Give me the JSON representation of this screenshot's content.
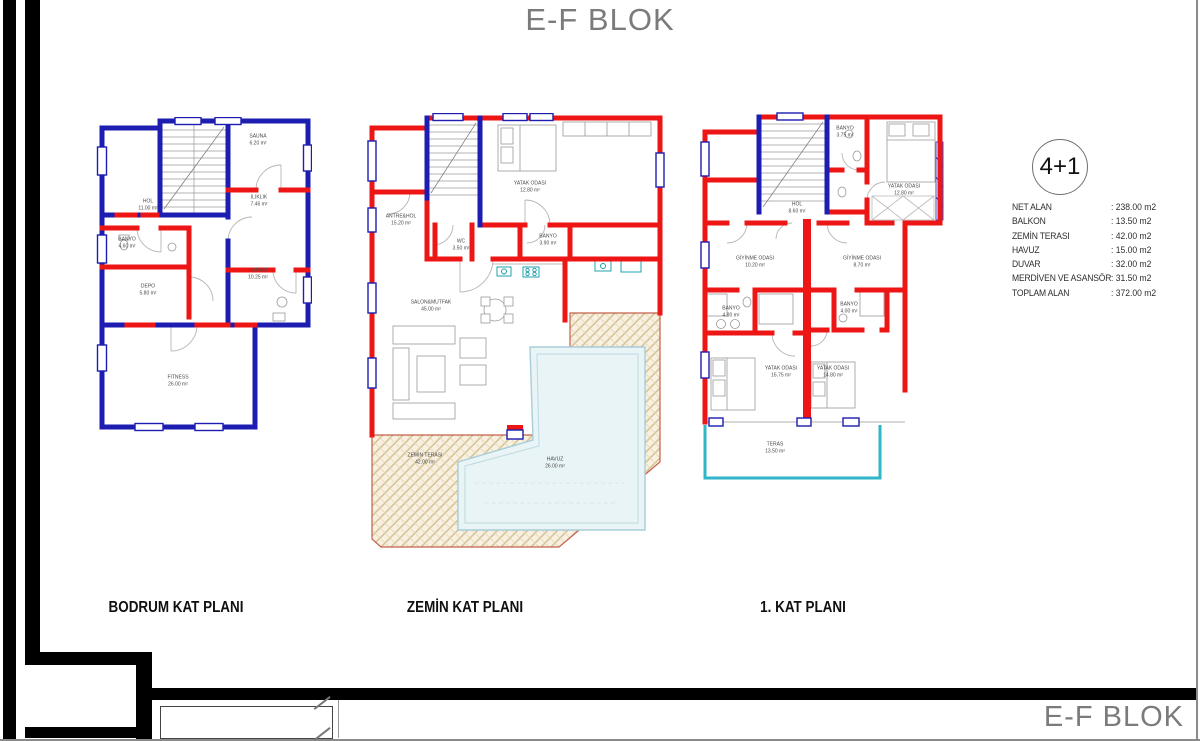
{
  "title": "E-F BLOK",
  "footer_title": "E-F BLOK",
  "unit_badge": "4+1",
  "colors": {
    "wall_blue": "#1d1db2",
    "wall_red": "#ee1515",
    "teras_cyan": "#2fb6c8",
    "terrace_outline": "#c4604a",
    "terrace_hatch": "#d6c397",
    "pool_fill": "#e9f4f7",
    "title_gray": "#7b7b7b"
  },
  "legend": {
    "rows": [
      {
        "label": "NET ALAN",
        "value": ": 238.00 m2"
      },
      {
        "label": "BALKON",
        "value": ": 13.50 m2"
      },
      {
        "label": "ZEMİN TERASI",
        "value": ": 42.00 m2"
      },
      {
        "label": "HAVUZ",
        "value": ": 15.00 m2"
      },
      {
        "label": "DUVAR",
        "value": ": 32.00 m2"
      },
      {
        "label": "MERDİVEN VE ASANSÖR",
        "value": ": 31.50 m2"
      },
      {
        "label": "TOPLAM ALAN",
        "value": ": 372.00 m2"
      }
    ]
  },
  "plans": [
    {
      "caption": "BODRUM KAT PLANI",
      "rooms": [
        {
          "name": "SAUNA",
          "area": "6.20 m²",
          "x": 181,
          "y": 23
        },
        {
          "name": "HOL",
          "area": "11.00 m²",
          "x": 71,
          "y": 88
        },
        {
          "name": "ILIKLIK",
          "area": "7.46 m²",
          "x": 182,
          "y": 84
        },
        {
          "name": "BANYO",
          "area": "4.60 m²",
          "x": 50,
          "y": 126
        },
        {
          "name": "DEPO",
          "area": "5.80 m²",
          "x": 71,
          "y": 173
        },
        {
          "name": "HAMAM",
          "area": "10.25 m²",
          "x": 181,
          "y": 157
        },
        {
          "name": "FITNESS",
          "area": "26.00 m²",
          "x": 101,
          "y": 264
        }
      ]
    },
    {
      "caption": "ZEMİN KAT PLANI",
      "rooms": [
        {
          "name": "YATAK ODASI",
          "area": "12.80 m²",
          "x": 165,
          "y": 74
        },
        {
          "name": "ANTRE&HOL",
          "area": "15.20 m²",
          "x": 36,
          "y": 107
        },
        {
          "name": "WC",
          "area": "3.50 m²",
          "x": 96,
          "y": 132
        },
        {
          "name": "BANYO",
          "area": "3.90 m²",
          "x": 183,
          "y": 127
        },
        {
          "name": "SALON&MUTFAK",
          "area": "45.00 m²",
          "x": 66,
          "y": 193
        },
        {
          "name": "ZEMİN TERASI",
          "area": "42.00 m²",
          "x": 60,
          "y": 346
        },
        {
          "name": "HAVUZ",
          "area": "26.00 m²",
          "x": 190,
          "y": 350
        }
      ]
    },
    {
      "caption": "1. KAT PLANI",
      "rooms": [
        {
          "name": "BANYO",
          "area": "3.75 m²",
          "x": 148,
          "y": 20
        },
        {
          "name": "YATAK ODASI",
          "area": "12.80 m²",
          "x": 207,
          "y": 78
        },
        {
          "name": "HOL",
          "area": "8.60 m²",
          "x": 100,
          "y": 96
        },
        {
          "name": "GİYİNME ODASI",
          "area": "10.20 m²",
          "x": 58,
          "y": 150
        },
        {
          "name": "GİYİNME ODASI",
          "area": "8.70 m²",
          "x": 165,
          "y": 150
        },
        {
          "name": "BANYO",
          "area": "4.80 m²",
          "x": 34,
          "y": 200
        },
        {
          "name": "BANYO",
          "area": "4.00 m²",
          "x": 152,
          "y": 196
        },
        {
          "name": "YATAK ODASI",
          "area": "16.75 m²",
          "x": 84,
          "y": 260
        },
        {
          "name": "YATAK ODASI",
          "area": "14.80 m²",
          "x": 136,
          "y": 260
        },
        {
          "name": "TERAS",
          "area": "13.50 m²",
          "x": 78,
          "y": 336
        }
      ]
    }
  ]
}
